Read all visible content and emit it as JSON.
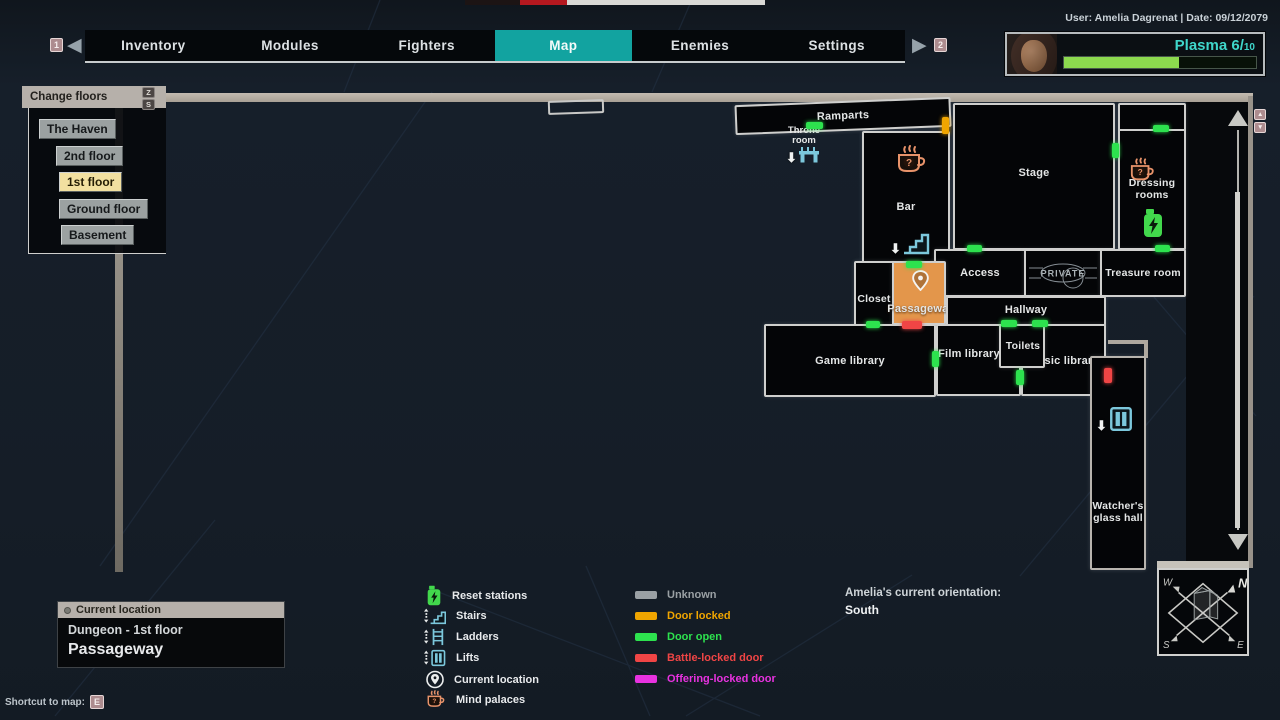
{
  "colors": {
    "accent-teal": "#12a3a0",
    "plasma-text": "#3fd6ca",
    "plasma-fill": "#8cd94e",
    "door-open": "#2de24e",
    "door-locked": "#f0a500",
    "door-battle": "#f04545",
    "door-offering": "#e832e0",
    "door-unknown": "#9aa0a4",
    "room-orange": "#e3964b",
    "icon-teal": "#7cc8dc",
    "icon-orange": "#e8936a",
    "icon-green": "#42d84c"
  },
  "top_bar": {
    "user_date": "User: Amelia Dagrenat | Date: 09/12/2079",
    "prev_badge": "1",
    "next_badge": "2"
  },
  "tabs": {
    "items": [
      {
        "label": "Inventory"
      },
      {
        "label": "Modules"
      },
      {
        "label": "Fighters"
      },
      {
        "label": "Map",
        "active": true
      },
      {
        "label": "Enemies"
      },
      {
        "label": "Settings"
      }
    ]
  },
  "player": {
    "resource_label": "Plasma",
    "resource_value": "6",
    "resource_slash": "/",
    "resource_max": "10",
    "bar_width": "60%"
  },
  "floor_panel": {
    "title": "Change floors",
    "key_up": "Z",
    "key_down": "S",
    "floors": [
      {
        "label": "The Haven"
      },
      {
        "label": "2nd floor"
      },
      {
        "label": "1st floor",
        "selected": true
      },
      {
        "label": "Ground floor"
      },
      {
        "label": "Basement"
      }
    ]
  },
  "map": {
    "rooms": [
      {
        "label": "Ramparts"
      },
      {
        "label": "Throne room"
      },
      {
        "label": "Bar"
      },
      {
        "label": "Stage"
      },
      {
        "label": "Dressing rooms"
      },
      {
        "label": "Access"
      },
      {
        "label": "PRIVATE"
      },
      {
        "label": "Treasure room"
      },
      {
        "label": "Closet"
      },
      {
        "label": "Passageway"
      },
      {
        "label": "Hallway"
      },
      {
        "label": "Game library"
      },
      {
        "label": "Film library"
      },
      {
        "label": "Toilets"
      },
      {
        "label": "Music library"
      },
      {
        "label": "Watcher's glass hall"
      }
    ],
    "scroll_key_up": "▲",
    "scroll_key_down": "▼"
  },
  "legend": {
    "features": [
      {
        "label": "Reset stations",
        "icon": "reset-station-icon"
      },
      {
        "label": "Stairs",
        "icon": "stairs-icon"
      },
      {
        "label": "Ladders",
        "icon": "ladder-icon"
      },
      {
        "label": "Lifts",
        "icon": "lift-icon"
      },
      {
        "label": "Current location",
        "icon": "location-pin-icon"
      },
      {
        "label": "Mind palaces",
        "icon": "mind-palace-icon"
      }
    ],
    "doors": [
      {
        "label": "Unknown",
        "color": "#9aa0a4"
      },
      {
        "label": "Door locked",
        "color": "#f0a500"
      },
      {
        "label": "Door open",
        "color": "#2de24e"
      },
      {
        "label": "Battle-locked door",
        "color": "#f04545"
      },
      {
        "label": "Offering-locked door",
        "color": "#e832e0"
      }
    ]
  },
  "location_panel": {
    "header": "Current location",
    "line1": "Dungeon - 1st floor",
    "line2": "Passageway"
  },
  "shortcut": {
    "label": "Shortcut to map:",
    "key": "E"
  },
  "orientation": {
    "label": "Amelia's current orientation:",
    "value": "South"
  },
  "compass": {
    "n": "N",
    "e": "E",
    "s": "S",
    "w": "W"
  }
}
